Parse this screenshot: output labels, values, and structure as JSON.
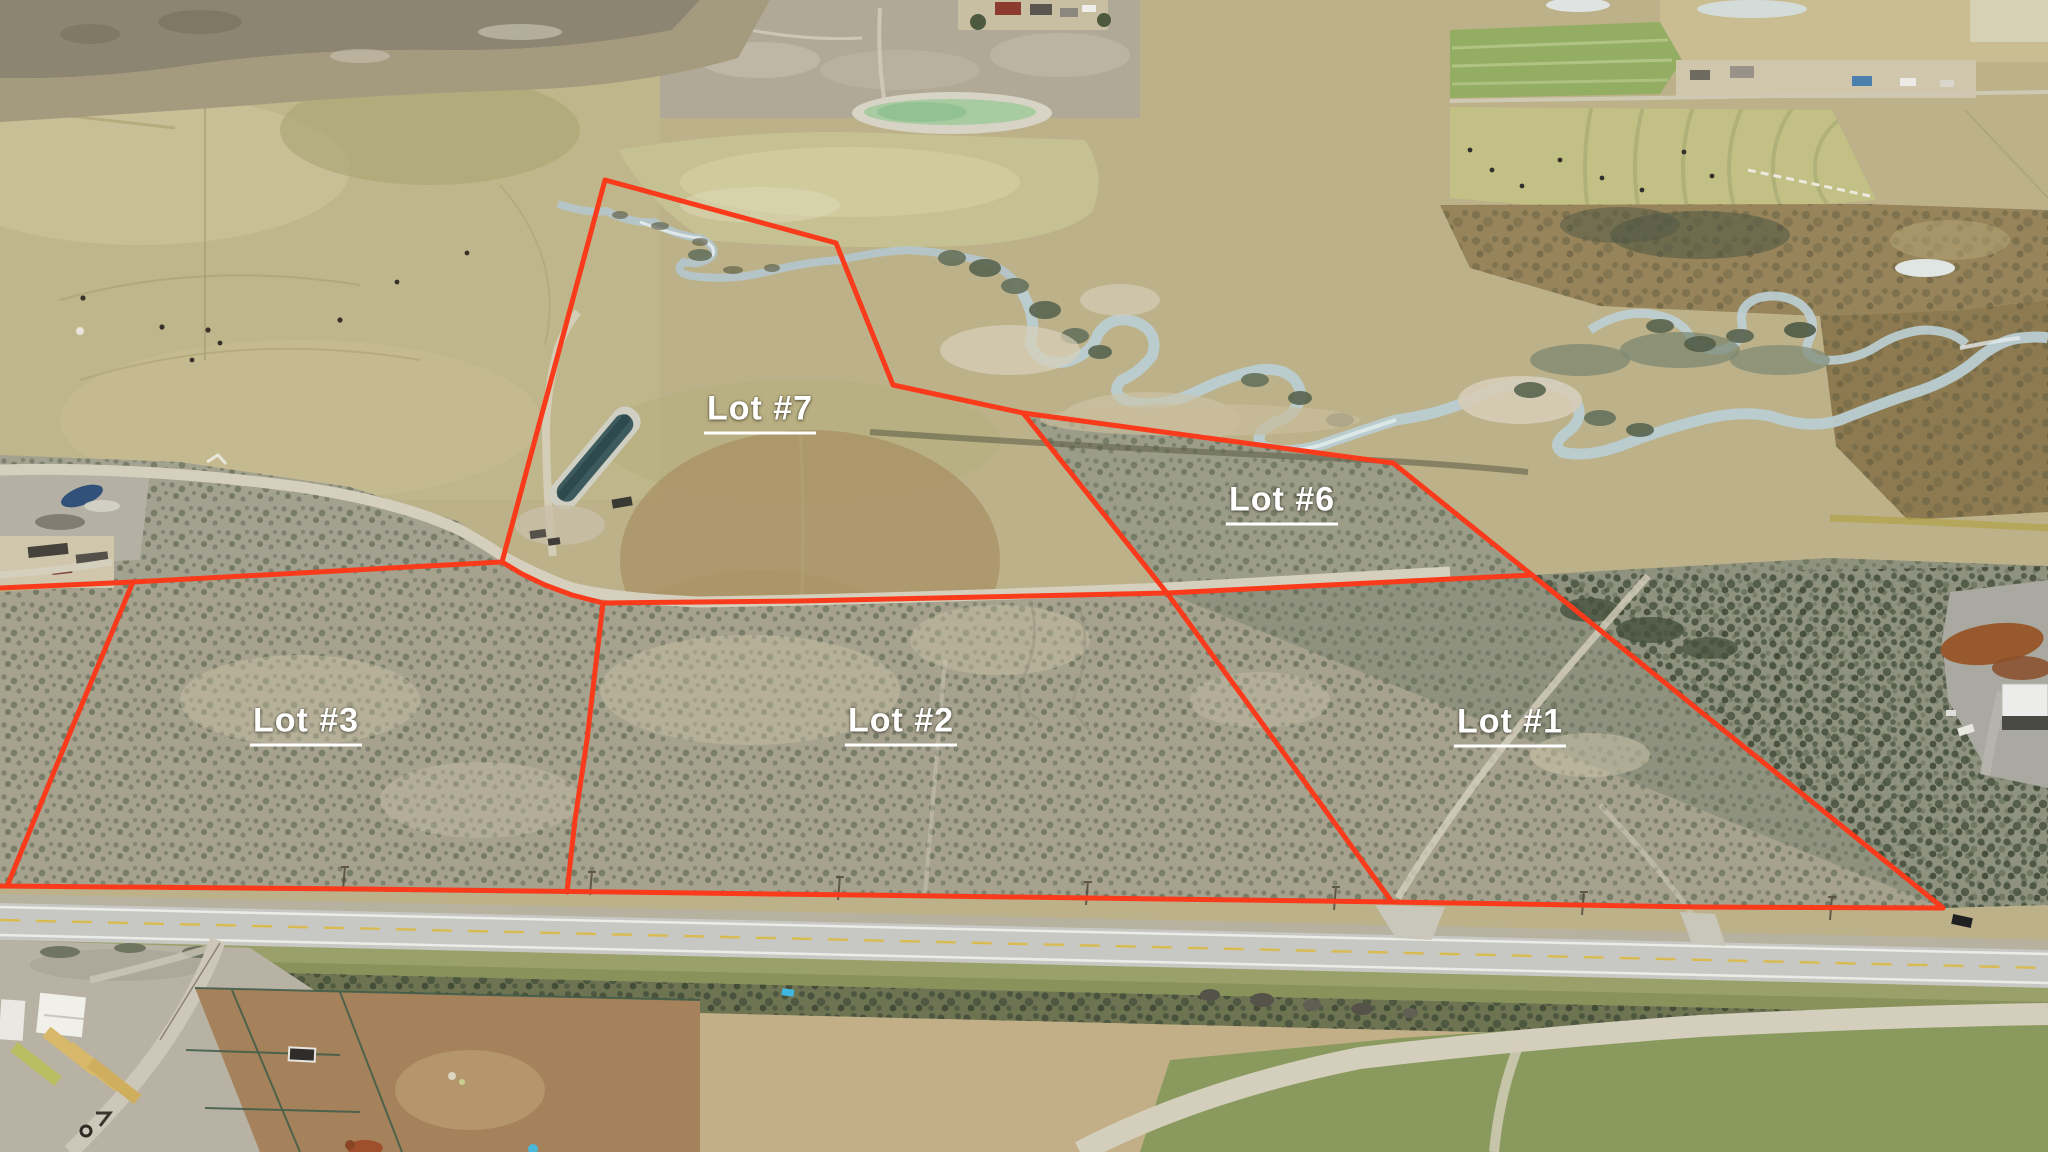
{
  "style": {
    "boundary_color": "#f93a1b",
    "boundary_width": 5,
    "label_color": "#ffffff",
    "label_font_size": 34
  },
  "lots": [
    {
      "id": "lot-7",
      "label": "Lot #7",
      "label_x": 760,
      "label_y": 412
    },
    {
      "id": "lot-6",
      "label": "Lot #6",
      "label_x": 1282,
      "label_y": 503
    },
    {
      "id": "lot-3",
      "label": "Lot #3",
      "label_x": 306,
      "label_y": 724
    },
    {
      "id": "lot-2",
      "label": "Lot #2",
      "label_x": 901,
      "label_y": 724
    },
    {
      "id": "lot-1",
      "label": "Lot #1",
      "label_x": 1510,
      "label_y": 725
    }
  ],
  "boundaries": [
    {
      "name": "north-road-line",
      "points": "0,588 133,582 502,562"
    },
    {
      "name": "junction-curve",
      "points": "502,562 522,574 545,585 572,595 603,603"
    },
    {
      "name": "lot2-north-line",
      "points": "603,603 800,601 1167,593"
    },
    {
      "name": "lot1-north-line",
      "points": "1167,593 1532,575"
    },
    {
      "name": "lot7-west-edge",
      "points": "502,562 605,180"
    },
    {
      "name": "lot7-north-east-edge",
      "points": "605,180 836,243 893,385 1023,413"
    },
    {
      "name": "lot6-north-edge",
      "points": "1023,413 1393,463"
    },
    {
      "name": "east-boundary",
      "points": "1393,463 1532,575 1943,908"
    },
    {
      "name": "lot6-west-lot1-lot2-divider",
      "points": "1023,413 1167,593 1243,697 1392,902"
    },
    {
      "name": "lot2-lot3-divider",
      "points": "603,603 587,740 575,820 567,892"
    },
    {
      "name": "lot3-west-edge",
      "points": "133,582 67,740 8,884"
    },
    {
      "name": "highway-line",
      "points": "0,886 360,889 860,895 1392,902 1700,907 1943,908"
    }
  ]
}
